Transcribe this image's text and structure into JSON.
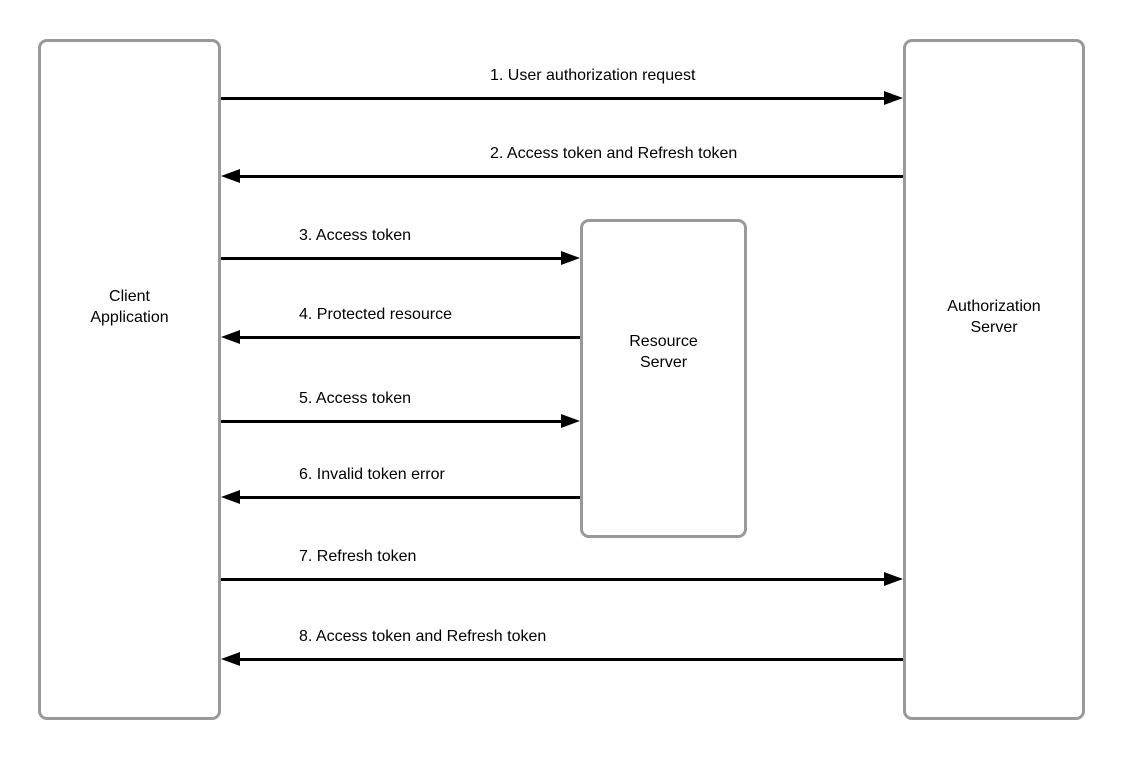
{
  "diagram": {
    "type": "sequence-flow",
    "entities": [
      {
        "id": "client",
        "label": "Client\nApplication"
      },
      {
        "id": "resource",
        "label": "Resource\nServer"
      },
      {
        "id": "auth",
        "label": "Authorization\nServer"
      }
    ],
    "messages": [
      {
        "num": "1",
        "label": "1. User authorization request",
        "from": "client",
        "to": "auth"
      },
      {
        "num": "2",
        "label": "2. Access token and Refresh token",
        "from": "auth",
        "to": "client"
      },
      {
        "num": "3",
        "label": "3. Access token",
        "from": "client",
        "to": "resource"
      },
      {
        "num": "4",
        "label": "4. Protected resource",
        "from": "resource",
        "to": "client"
      },
      {
        "num": "5",
        "label": "5. Access token",
        "from": "client",
        "to": "resource"
      },
      {
        "num": "6",
        "label": "6. Invalid token error",
        "from": "resource",
        "to": "client"
      },
      {
        "num": "7",
        "label": "7. Refresh token",
        "from": "client",
        "to": "auth"
      },
      {
        "num": "8",
        "label": "8. Access token and Refresh token",
        "from": "auth",
        "to": "client"
      }
    ],
    "colors": {
      "box_border": "#999999",
      "box_fill": "#ffffff",
      "arrow": "#000000",
      "text": "#000000",
      "background": "#ffffff"
    }
  }
}
